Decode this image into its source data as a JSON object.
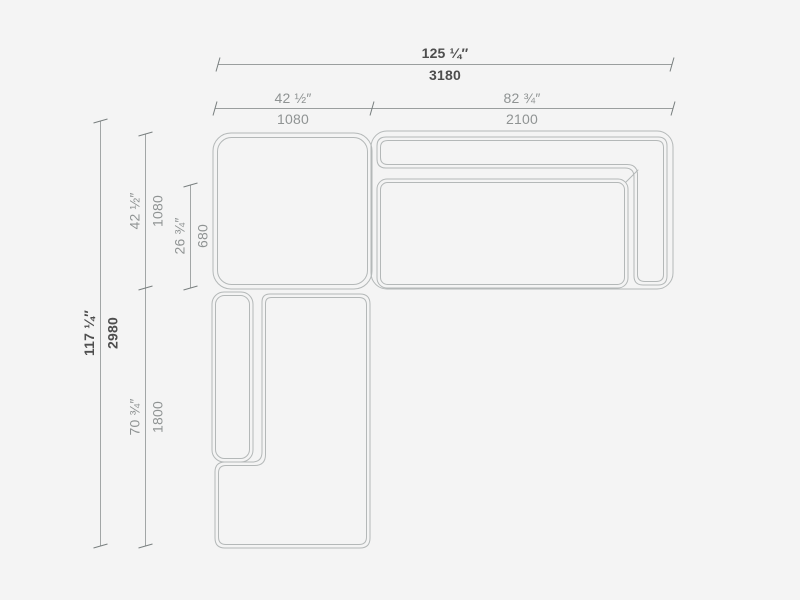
{
  "colors": {
    "background": "#f4f4f4",
    "drawing_line": "#b4b8b8",
    "dimension_line": "#9a9e9e",
    "primary_text": "#4e4e4e",
    "secondary_text": "#8f9393"
  },
  "diagram": {
    "dimensions": {
      "overall_width": {
        "inches": "125 ¼″",
        "mm": "3180"
      },
      "module_left_width": {
        "inches": "42 ½″",
        "mm": "1080"
      },
      "module_right_width": {
        "inches": "82 ¾″",
        "mm": "2100"
      },
      "overall_depth": {
        "inches": "117 ¼″",
        "mm": "2980"
      },
      "corner_depth": {
        "inches": "42 ½″",
        "mm": "1080"
      },
      "seat_depth": {
        "inches": "26 ¾″",
        "mm": "680"
      },
      "chaise_depth": {
        "inches": "70 ¾″",
        "mm": "1800"
      }
    }
  }
}
